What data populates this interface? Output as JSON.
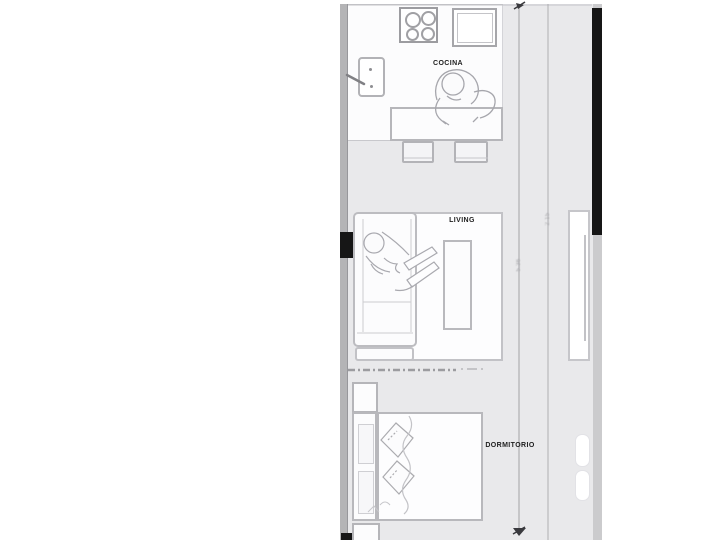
{
  "plan_title": "studio-apartment-floor-plan",
  "rooms": {
    "cocina": {
      "label": "COCINA"
    },
    "living": {
      "label": "LIVING"
    },
    "dormitorio": {
      "label": "DORMITORIO"
    }
  },
  "dimensions": {
    "inner": {
      "label": "5.36",
      "orientation": "vertical"
    },
    "outer": {
      "label": "2.15",
      "orientation": "vertical"
    }
  },
  "elements": [
    "stove-4-burners",
    "fridge",
    "kitchen-sink-with-faucet",
    "kitchen-island",
    "bar-stool",
    "bar-stool",
    "standing-person-sketch",
    "sofa",
    "chaise",
    "lounging-person-sketch",
    "coffee-table",
    "area-rug",
    "sliding-partition-dashed",
    "nightstand",
    "nightstand",
    "headboard",
    "double-bed",
    "pillow",
    "pillow",
    "window-opening",
    "door-markers",
    "black-wall-segments",
    "dimension-lines-with-arrows"
  ],
  "colors": {
    "floor": "#e9e9eb",
    "white": "#fdfdfe",
    "outline": "#bcbcc0",
    "outline_dark": "#9c9ca0",
    "wall_dark": "#161616",
    "wall_gray": "#b4b4b6",
    "edge_strip": "#cbcbcd",
    "label": "#1e1e1e",
    "dim": "#a5a5a9",
    "sketch": "#a9a9af"
  }
}
